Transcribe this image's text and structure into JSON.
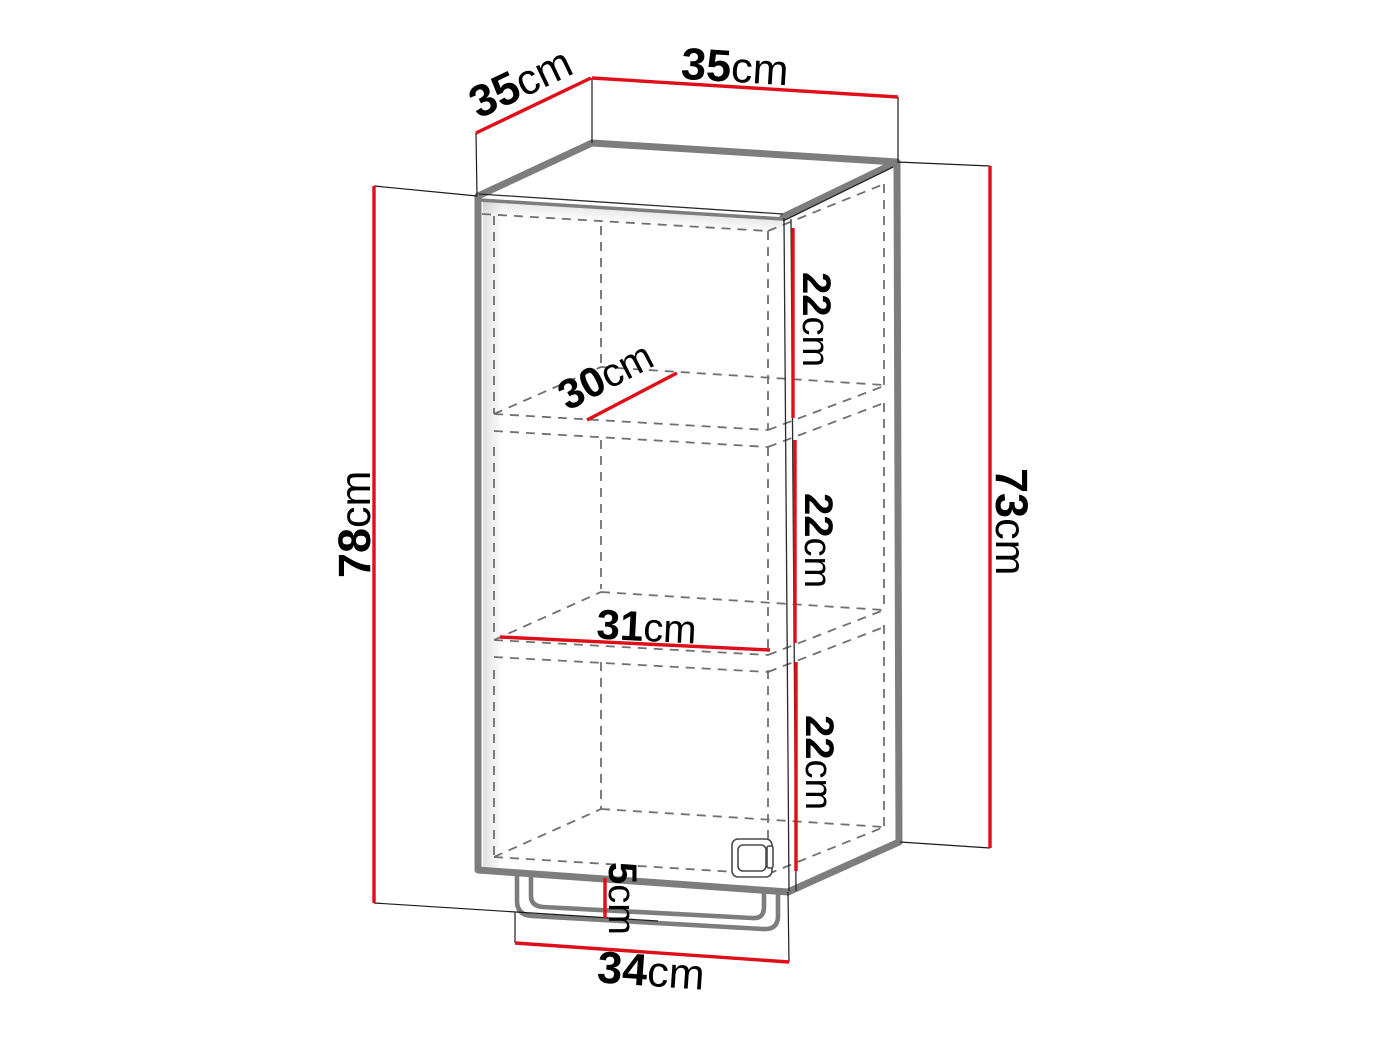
{
  "diagram": {
    "subject": "wall-cabinet-dimension-drawing",
    "colors": {
      "dimension": "#df0e18",
      "outline": "#7d7d7d",
      "dashed": "#707070",
      "text": "#000000",
      "background": "#ffffff"
    },
    "dimensions": {
      "depth": {
        "value": "35",
        "unit": "cm"
      },
      "width": {
        "value": "35",
        "unit": "cm"
      },
      "height_total": {
        "value": "78",
        "unit": "cm"
      },
      "height_side": {
        "value": "73",
        "unit": "cm"
      },
      "section_top": {
        "value": "22",
        "unit": "cm"
      },
      "section_middle": {
        "value": "22",
        "unit": "cm"
      },
      "section_bottom": {
        "value": "22",
        "unit": "cm"
      },
      "shelf_depth": {
        "value": "30",
        "unit": "cm"
      },
      "shelf_width": {
        "value": "31",
        "unit": "cm"
      },
      "base_width": {
        "value": "34",
        "unit": "cm"
      },
      "base_height": {
        "value": "5",
        "unit": "cm"
      }
    }
  }
}
